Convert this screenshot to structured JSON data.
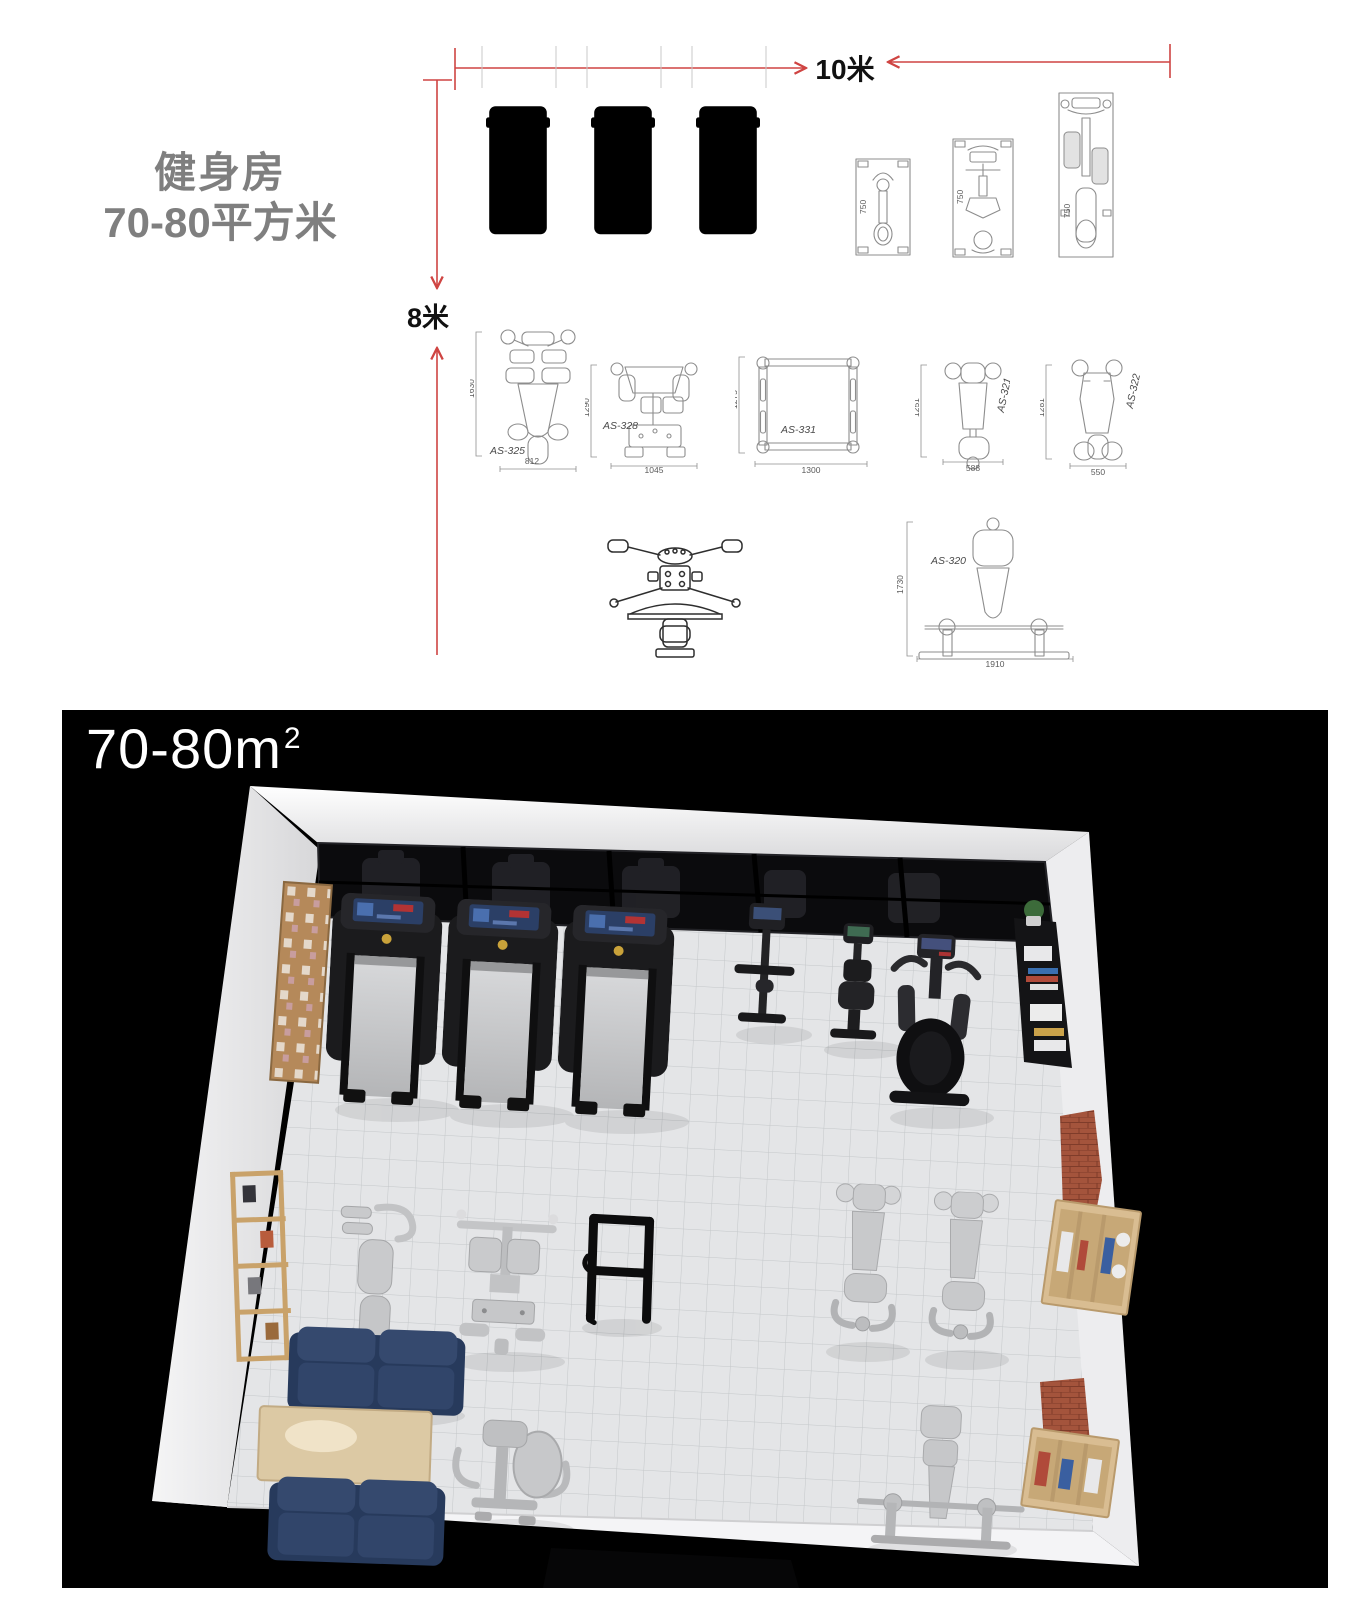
{
  "header": {
    "title_line1": "健身房",
    "title_line2": "70-80平方米",
    "width_label": "10米",
    "height_label": "8米"
  },
  "cad": {
    "machines": [
      {
        "model": "AS-325",
        "h": "1630",
        "w": "812"
      },
      {
        "model": "AS-328",
        "h": "1290",
        "w": "1045"
      },
      {
        "model": "AS-331",
        "h": "1275",
        "w": "1300"
      },
      {
        "model": "AS-321",
        "h": "1251",
        "w": "588"
      },
      {
        "model": "AS-322",
        "h": "1281",
        "w": "550"
      },
      {
        "model": "AS-320",
        "h": "1730",
        "w": "1910"
      }
    ],
    "cardio_depth_labels": [
      "750",
      "750",
      "750"
    ]
  },
  "render": {
    "area_value": "70-80m",
    "area_exponent": "2"
  }
}
